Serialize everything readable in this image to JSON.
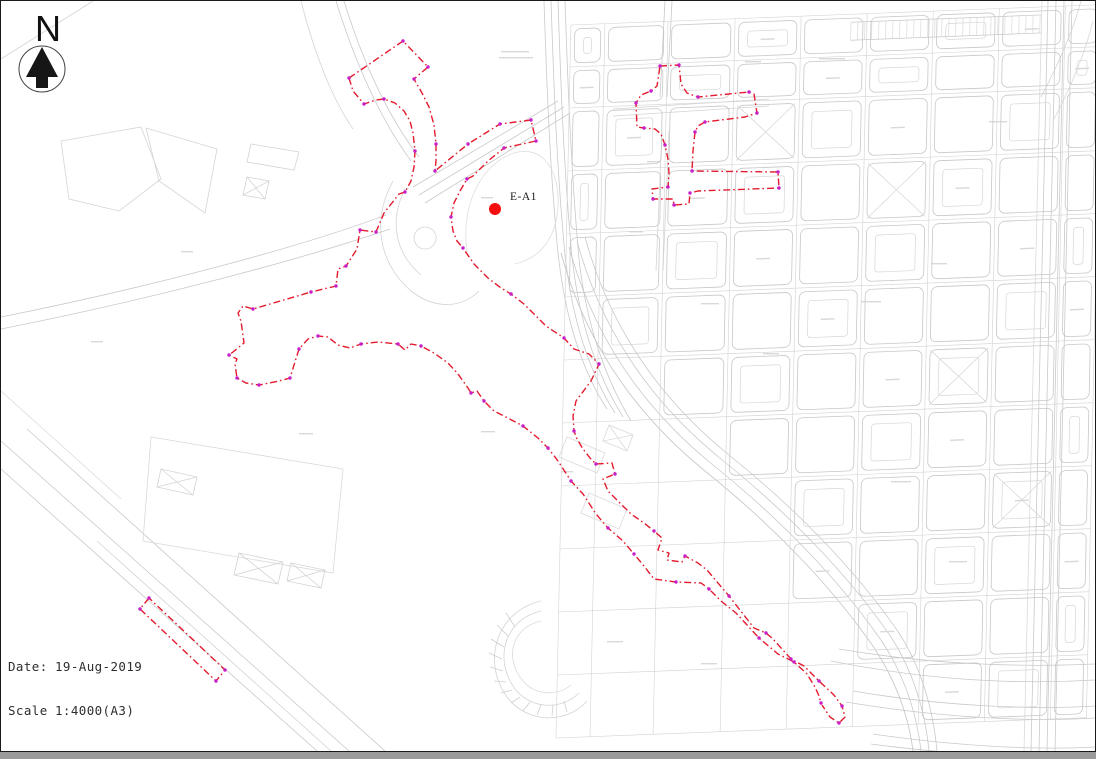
{
  "north_arrow": {
    "label": "N"
  },
  "marker": {
    "label": "E-A1"
  },
  "footer": {
    "date_label": "Date:",
    "date_value": "19-Aug-2019",
    "scale_label": "Scale",
    "scale_value": "1:4000(A3)"
  },
  "map": {
    "width": 1094,
    "height": 750,
    "palette": {
      "road": "#c9c9c9",
      "road_light": "#dadada",
      "boundary": "#e31b2d",
      "node": "#c81ec8",
      "marker": "#f60d0d",
      "smudge": "#d9d9d9",
      "grid_line": "#d2d2d2",
      "block": "#c7c7c7"
    },
    "marker": {
      "x": 494,
      "y": 208,
      "r": 6,
      "label_x": 509,
      "label_y": 199
    },
    "boundary": {
      "dash": "7 3 1.6 3",
      "width": 1.4,
      "paths": [
        "M348,77 L402,40 L427,66 L413,78 L421,92 L428,106 L433,124 L435,143 L435,160 L434,170 L467,143 L499,123 L530,119 L535,140 L503,147 L487,160 L472,175 L466,178 L459,190 L453,202 L450,216 L452,230 L456,240 L462,247 L473,263 L487,277 L500,287 L510,293 L523,303 L545,325 L563,337 L573,348 L588,353 L593,358 L598,363 L590,380 L575,400 L572,415 L573,430 L576,438 L582,448 L589,457 L595,463 L611,462 L614,473 L602,478 L607,490 L617,500 L630,513 L643,522 L653,530 L661,537 L657,549 L668,552 L666,559 L681,561 L684,555 L697,562 L706,569 L728,595 L753,627 L765,632 L772,638 L790,658 L803,665 L818,680 L833,694 L841,705 L844,716 L838,722 L829,716 L821,704",
        "M348,77 L352,90 L363,103 L375,99 L383,98 L394,102 L403,110 L409,120 L412,132 L414,150 L413,166 L410,180 L404,191 L398,193 L383,212 L375,231 L359,229 L356,248 L345,265 L337,268 L335,285 L310,291 L252,308 L242,305 L237,312 L240,320 L243,342 L232,351 L228,354 L236,358 L234,363 L236,377 L245,382 L258,384 L278,380 L289,377 L298,348 L307,338 L317,335 L327,336 L337,344 L349,347 L360,343 L377,341 L397,343 L404,349 L410,343 L420,345 L433,352 L447,362 L457,373 L467,387 L470,392 L476,390 L483,400 L493,410 L503,415 L522,425 L537,437 L547,447 L557,460 L570,480 L582,493 L595,513 L607,527 L622,540 L633,553 L643,565 L653,578 L675,581 L700,582 L708,588 L720,600 L735,612 L747,625 L758,637 L777,653 L793,661 L806,673 L814,686 L818,695 L820,702",
        "M659,65 L678,64 L680,83 L686,92 L697,96 L748,91 L753,93 L756,112 L744,116 L704,121 L697,125 L694,131 L692,150 L691,170 L777,171 L778,187 L697,190 L689,192 L688,203 L673,204 L672,198 L652,198 L651,188 L667,186 L668,172 L667,158 L664,144 L660,133 L654,128 L643,127 L636,126 L635,102 L640,94 L650,90 L656,85 Z",
        "M148,597 L139,608 L215,680 L224,669 Z"
      ],
      "nodes": [
        [
          402,
          40
        ],
        [
          427,
          66
        ],
        [
          413,
          78
        ],
        [
          435,
          143
        ],
        [
          434,
          170
        ],
        [
          467,
          143
        ],
        [
          499,
          123
        ],
        [
          530,
          119
        ],
        [
          535,
          140
        ],
        [
          503,
          147
        ],
        [
          466,
          178
        ],
        [
          450,
          216
        ],
        [
          462,
          247
        ],
        [
          510,
          293
        ],
        [
          563,
          337
        ],
        [
          598,
          363
        ],
        [
          573,
          430
        ],
        [
          595,
          463
        ],
        [
          614,
          473
        ],
        [
          653,
          530
        ],
        [
          684,
          555
        ],
        [
          728,
          595
        ],
        [
          765,
          632
        ],
        [
          790,
          658
        ],
        [
          818,
          680
        ],
        [
          841,
          705
        ],
        [
          838,
          722
        ],
        [
          348,
          77
        ],
        [
          363,
          103
        ],
        [
          383,
          98
        ],
        [
          414,
          150
        ],
        [
          404,
          191
        ],
        [
          375,
          231
        ],
        [
          359,
          229
        ],
        [
          345,
          265
        ],
        [
          335,
          285
        ],
        [
          310,
          291
        ],
        [
          252,
          308
        ],
        [
          228,
          354
        ],
        [
          236,
          377
        ],
        [
          258,
          384
        ],
        [
          289,
          377
        ],
        [
          298,
          348
        ],
        [
          317,
          335
        ],
        [
          360,
          343
        ],
        [
          397,
          343
        ],
        [
          420,
          345
        ],
        [
          470,
          392
        ],
        [
          483,
          400
        ],
        [
          522,
          425
        ],
        [
          547,
          447
        ],
        [
          570,
          480
        ],
        [
          607,
          527
        ],
        [
          633,
          553
        ],
        [
          675,
          581
        ],
        [
          708,
          588
        ],
        [
          758,
          637
        ],
        [
          793,
          661
        ],
        [
          820,
          702
        ],
        [
          659,
          65
        ],
        [
          678,
          64
        ],
        [
          697,
          96
        ],
        [
          748,
          91
        ],
        [
          756,
          112
        ],
        [
          704,
          121
        ],
        [
          694,
          131
        ],
        [
          691,
          170
        ],
        [
          777,
          171
        ],
        [
          778,
          187
        ],
        [
          689,
          192
        ],
        [
          673,
          204
        ],
        [
          652,
          198
        ],
        [
          667,
          186
        ],
        [
          664,
          144
        ],
        [
          643,
          127
        ],
        [
          635,
          102
        ],
        [
          650,
          90
        ],
        [
          148,
          597
        ],
        [
          139,
          608
        ],
        [
          215,
          680
        ],
        [
          224,
          669
        ]
      ]
    },
    "roads": [
      {
        "d": "M543,0 C546,90 549,170 557,252 C564,316 580,368 606,408"
      },
      {
        "d": "M550,0 C553,90 556,170 564,254 C571,318 588,371 614,412"
      },
      {
        "d": "M557,0 C560,90 563,170 571,256 C578,320 596,374 622,416"
      },
      {
        "d": "M564,0 C567,88 570,168 578,258 C585,322 604,377 630,420"
      },
      {
        "d": "M560,252 C586,348 640,418 704,470 C770,523 830,584 874,648 C897,684 908,718 912,750",
        "w": 0.9
      },
      {
        "d": "M568,246 C594,342 648,412 712,464 C778,517 838,578 882,642 C905,678 916,714 920,750"
      },
      {
        "d": "M576,240 C602,336 656,406 720,458 C786,511 846,572 890,636 C913,672 924,710 928,750"
      },
      {
        "d": "M584,236 C610,332 664,402 728,454 C794,507 854,568 898,632 C921,668 932,708 936,750"
      },
      {
        "d": "M412,186 L557,100"
      },
      {
        "d": "M418,194 L563,106"
      },
      {
        "d": "M424,202 L569,112"
      },
      {
        "d": "M335,0 C353,58 378,116 410,160"
      },
      {
        "d": "M343,0 C361,58 386,114 418,156"
      },
      {
        "d": "M392,180 C370,220 378,262 410,290 C436,310 462,306 478,290",
        "c": "#d4d4d4"
      },
      {
        "d": "M404,188 C388,220 394,252 420,274",
        "c": "#d4d4d4"
      },
      {
        "d": "M424,226 a11,11 0 1 0 0.2,0",
        "c": "#d4d4d4"
      },
      {
        "d": "M385,214 C300,246 150,286 0,316"
      },
      {
        "d": "M389,228 C302,258 152,298 0,328"
      },
      {
        "d": "M0,440 L348,750"
      },
      {
        "d": "M0,468 L316,750"
      },
      {
        "d": "M26,428 L384,750"
      },
      {
        "d": "M96,540 L330,750",
        "c": "#d4d4d4"
      },
      {
        "d": "M0,390 L120,498",
        "c": "#dadada"
      },
      {
        "d": "M60,140 L140,126 L160,178 L118,210 L68,198 Z",
        "c": "#d4d4d4"
      },
      {
        "d": "M145,127 L216,148 L204,212 L158,180 Z",
        "c": "#d4d4d4"
      },
      {
        "d": "M250,143 L298,151 L293,169 L246,161 Z",
        "c": "#d4d4d4"
      },
      {
        "d": "M0,58 L92,0",
        "c": "#d4d4d4"
      },
      {
        "d": "M300,0 C312,48 330,96 352,128",
        "c": "#d4d4d4"
      },
      {
        "d": "M150,436 L342,468 L332,572 L142,540 Z",
        "c": "#dadada"
      },
      {
        "d": "M238,552 L282,561 L277,583 L233,574 Z M238,552 L277,583 M282,561 L233,574",
        "c": "#d4d4d4"
      },
      {
        "d": "M290,562 L324,569 L320,587 L286,580 Z M290,562 L320,587 M324,569 L286,580",
        "c": "#d4d4d4"
      },
      {
        "d": "M160,468 L196,476 L192,494 L156,486 Z M160,468 L192,494 M196,476 L156,486",
        "c": "#d4d4d4"
      },
      {
        "d": "M246,176 L268,180 L264,198 L242,194 Z M246,176 L264,198 M268,180 L242,194",
        "c": "#d4d4d4"
      },
      {
        "d": "M466,252 C460,206 478,166 510,153 C543,141 559,172 557,206 C555,236 540,257 514,263",
        "c": "#dedede"
      },
      {
        "d": "M540,600 C496,610 480,660 506,696 C526,723 566,723 586,700",
        "c": "#d4d4d4"
      },
      {
        "d": "M540,610 C504,618 492,658 514,688 C531,709 561,709 578,692",
        "c": "#d4d4d4"
      },
      {
        "d": "M540,620 C512,626 502,656 522,680 C535,695 557,695 570,684",
        "c": "#dadada"
      },
      {
        "d": "M505,612 L514,626 M496,624 L507,635 M490,638 L503,646 M488,652 L501,658 M489,666 L502,670 M493,680 L505,681 M500,692 L511,689 M510,702 L519,696 M522,710 L529,701 M536,714 L540,704 M551,715 L552,704 M566,711 L563,700",
        "c": "#cfcfcf"
      },
      {
        "d": "M566,436 L604,452 L596,472 L558,456 Z",
        "c": "#dadada"
      },
      {
        "d": "M588,492 L626,508 L618,528 L580,512 Z",
        "c": "#dadada"
      },
      {
        "d": "M608,424 L632,434 L626,450 L602,440 Z M608,424 L626,450 M632,434 L602,440",
        "c": "#dadada"
      },
      {
        "d": "M838,648 C920,662 1010,667 1094,663"
      },
      {
        "d": "M830,660 C920,678 1010,684 1094,679"
      },
      {
        "d": "M852,690 C940,705 1030,709 1094,705"
      },
      {
        "d": "M845,701 C940,717 1030,721 1094,717"
      },
      {
        "d": "M872,733 C960,746 1040,749 1094,746"
      },
      {
        "d": "M870,743 C960,755 1040,757 1094,755"
      },
      {
        "d": "M1047,0 L1030,750"
      },
      {
        "d": "M1055,0 L1038,750"
      },
      {
        "d": "M1063,0 L1046,750"
      },
      {
        "d": "M1071,0 L1054,750"
      },
      {
        "d": "M1041,0 L1023,750",
        "c": "#dadada"
      },
      {
        "d": "M1040,96 C1058,62 1072,30 1080,0",
        "c": "#d4d4d4"
      },
      {
        "d": "M1052,120 C1070,86 1084,52 1092,20",
        "c": "#dadada"
      },
      {
        "d": "M664,0 L659,96"
      },
      {
        "d": "M671,0 L666,96"
      },
      {
        "d": "M661,130 L655,270",
        "c": "#d4d4d4"
      },
      {
        "d": "M668,130 L662,270",
        "c": "#d4d4d4"
      },
      {
        "d": "M612,108 L768,98",
        "c": "#d4d4d4"
      },
      {
        "d": "M612,115 L768,105",
        "c": "#d4d4d4"
      }
    ],
    "smudges": [
      [
        500,
        50,
        28
      ],
      [
        498,
        56,
        34
      ],
      [
        818,
        57,
        26
      ],
      [
        744,
        60,
        16
      ],
      [
        628,
        230,
        14
      ],
      [
        700,
        302,
        18
      ],
      [
        762,
        352,
        16
      ],
      [
        298,
        432,
        14
      ],
      [
        180,
        250,
        12
      ],
      [
        90,
        340,
        12
      ],
      [
        480,
        430,
        14
      ],
      [
        560,
        470,
        12
      ],
      [
        606,
        640,
        16
      ],
      [
        700,
        662,
        16
      ],
      [
        860,
        300,
        20
      ],
      [
        930,
        262,
        16
      ],
      [
        988,
        120,
        18
      ],
      [
        890,
        480,
        20
      ],
      [
        948,
        560,
        18
      ],
      [
        646,
        160,
        14
      ],
      [
        480,
        196,
        12
      ]
    ],
    "grid": {
      "ox": 570,
      "oy": 20,
      "skew_x": -1.2,
      "skew_y": -2.2,
      "cols": [
        0,
        34,
        97,
        164,
        230,
        296,
        362,
        428,
        494,
        530
      ],
      "rows": [
        4,
        46,
        87,
        150,
        213,
        276,
        339,
        402,
        465,
        528,
        591,
        654,
        717
      ],
      "skip": [
        "0,5",
        "0,6",
        "1,6",
        "0,7",
        "1,7",
        "2,7",
        "0,8",
        "1,8",
        "2,8",
        "3,8",
        "0,9",
        "1,9",
        "2,9",
        "3,9",
        "0,10",
        "1,10",
        "2,10",
        "3,10",
        "4,10",
        "0,11",
        "1,11",
        "2,11",
        "3,11",
        "4,11",
        "5,11"
      ],
      "xmarks": [
        [
          5,
          3
        ],
        [
          3,
          2
        ],
        [
          6,
          6
        ],
        [
          7,
          8
        ]
      ],
      "comb": {
        "x1": 280,
        "x2": 470,
        "y1": 12,
        "y2": 30,
        "step": 7
      }
    }
  }
}
